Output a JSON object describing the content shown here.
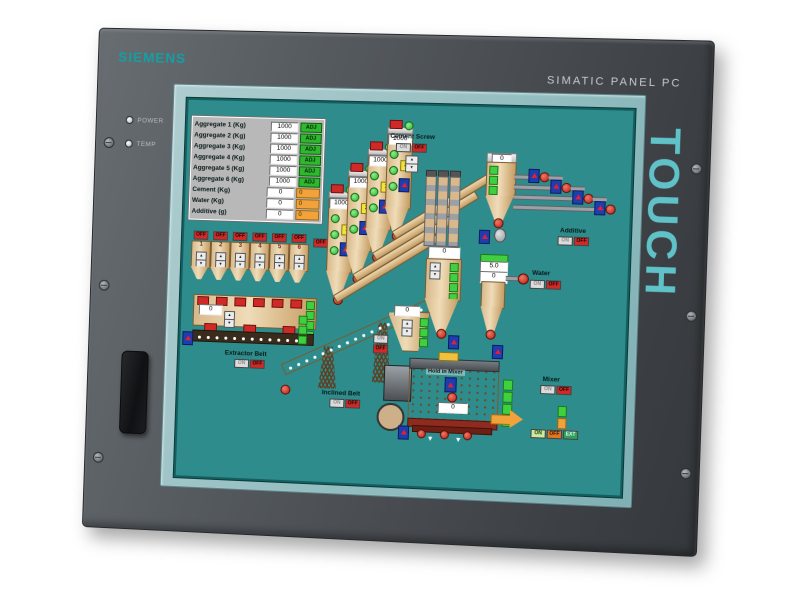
{
  "bezel": {
    "brand": "SIEMENS",
    "model": "SIMATIC PANEL PC",
    "touch_label": "TOUCH",
    "leds": [
      {
        "label": "POWER"
      },
      {
        "label": "TEMP"
      }
    ]
  },
  "colors": {
    "siemens_teal": "#12a0a4",
    "touch_teal": "#63ced4",
    "screen_teal": "#2e8c8c",
    "alarm_red": "#cf2a27",
    "ok_green": "#2eb82e",
    "warn_orange": "#f2a23a"
  },
  "screen": {
    "controls": {
      "on": "ON",
      "off": "OFF",
      "adj": "ADJ",
      "ext": "EXT"
    },
    "batch_table": {
      "rows": [
        {
          "label": "Aggregate 1 (Kg)",
          "value": "1000",
          "action": "ADJ"
        },
        {
          "label": "Aggregate 2 (Kg)",
          "value": "1000",
          "action": "ADJ"
        },
        {
          "label": "Aggregate 3 (Kg)",
          "value": "1000",
          "action": "ADJ"
        },
        {
          "label": "Aggregate 4 (Kg)",
          "value": "1000",
          "action": "ADJ"
        },
        {
          "label": "Aggregate 5 (Kg)",
          "value": "1000",
          "action": "ADJ"
        },
        {
          "label": "Aggregate 6 (Kg)",
          "value": "1000",
          "action": "ADJ"
        },
        {
          "label": "Cement (Kg)",
          "value": "0",
          "action": "0"
        },
        {
          "label": "Water (Kg)",
          "value": "0",
          "action": "0"
        },
        {
          "label": "Additive (g)",
          "value": "0",
          "action": "0"
        }
      ]
    },
    "aggregate_bins": {
      "items": [
        {
          "number": "1"
        },
        {
          "number": "2"
        },
        {
          "number": "3"
        },
        {
          "number": "4"
        },
        {
          "number": "5"
        },
        {
          "number": "6"
        }
      ]
    },
    "extractor_belt": {
      "label": "Extractor Belt",
      "hopper_value": "0"
    },
    "inclined_belt": {
      "label": "Inclined Belt"
    },
    "cement_screw": {
      "label": "Cement Screw"
    },
    "silos": [
      {
        "value": "1000",
        "scale": "1"
      },
      {
        "value": "1000",
        "scale": "2"
      },
      {
        "value": "1000",
        "scale": "1"
      },
      {
        "value": "1000",
        "scale": "2"
      }
    ],
    "cement_weigher": {
      "value": "0"
    },
    "additive": {
      "label": "Additive"
    },
    "aggregate_weigher": {
      "value": "0"
    },
    "water": {
      "label": "Water",
      "setpoint": "5.0",
      "value": "0"
    },
    "transfer_hopper": {
      "value": "0"
    },
    "mixer": {
      "label": "Mixer",
      "drum_label": "Hold in Mixer",
      "value": "0"
    }
  }
}
